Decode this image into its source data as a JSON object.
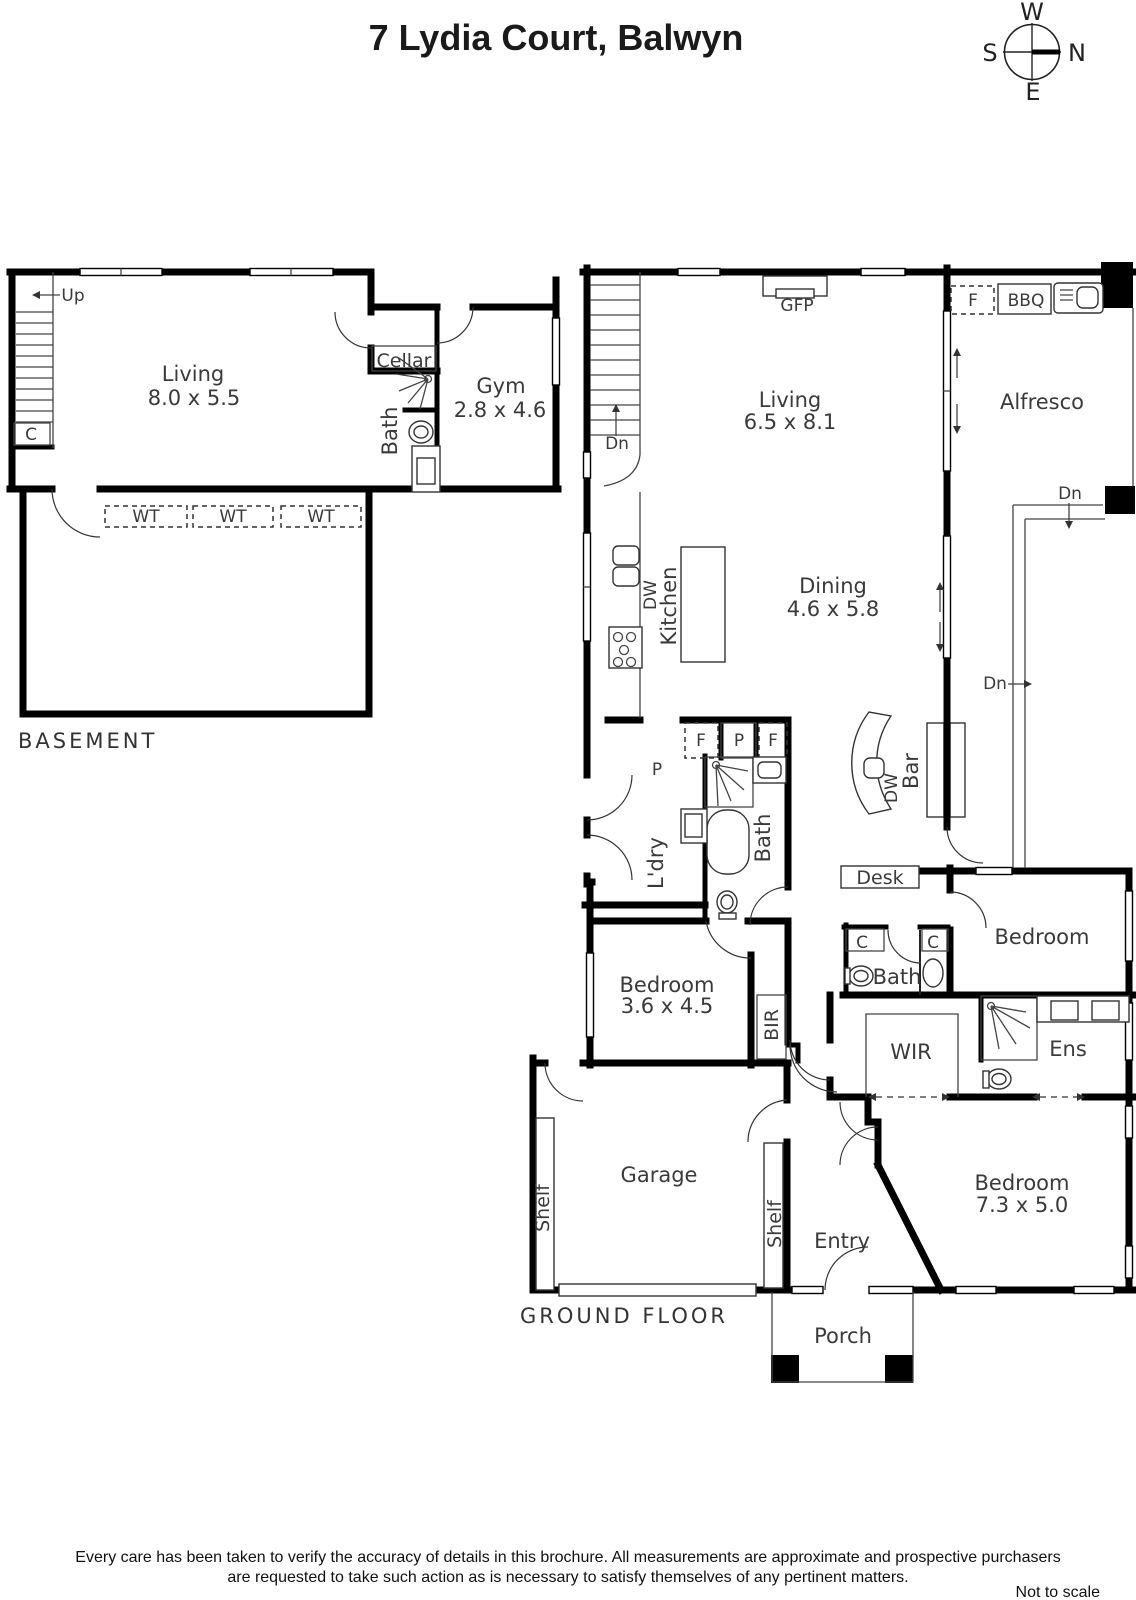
{
  "colors": {
    "wall": "#000000",
    "label": "#3a3a3a",
    "background": "#ffffff"
  },
  "title": "7 Lydia Court, Balwyn",
  "compass": {
    "top": "W",
    "right": "N",
    "left": "S",
    "bottom": "E"
  },
  "basement": {
    "floor": "BASEMENT",
    "up": "Up",
    "closet": "C",
    "living": "Living",
    "living_dims": "8.0 x 5.5",
    "cellar": "Cellar",
    "bath": "Bath",
    "gym": "Gym",
    "gym_dims": "2.8 x 4.6",
    "wt1": "WT",
    "wt2": "WT",
    "wt3": "WT"
  },
  "ground": {
    "floor": "GROUND FLOOR",
    "dn_stairs": "Dn",
    "gfp": "GFP",
    "living": "Living",
    "living_dims": "6.5 x 8.1",
    "fridge": "F",
    "bbq": "BBQ",
    "alfresco": "Alfresco",
    "dn_deck": "Dn",
    "dn_path": "Dn",
    "dw_kitchen": "DW",
    "kitchen": "Kitchen",
    "dining": "Dining",
    "dining_dims": "4.6 x 5.8",
    "pantry": "P",
    "f1": "F",
    "p1": "P",
    "f2": "F",
    "ldry": "L'dry",
    "bath": "Bath",
    "dw_bar": "DW",
    "bar": "Bar",
    "desk": "Desk",
    "bedroom2": "Bedroom",
    "c1": "C",
    "c2": "C",
    "bath2": "Bath",
    "bedroom3": "Bedroom",
    "bedroom3_dims": "3.6 x 4.5",
    "bir": "BIR",
    "wir": "WIR",
    "ens": "Ens",
    "shelf1": "Shelf",
    "garage": "Garage",
    "shelf2": "Shelf",
    "entry": "Entry",
    "bedroom1": "Bedroom",
    "bedroom1_dims": "7.3 x 5.0",
    "porch": "Porch"
  },
  "footer": {
    "disclaimer_line1": "Every care has been taken to verify the accuracy of details in this brochure.  All measurements are approximate and prospective purchasers",
    "disclaimer_line2": "are requested to take such action as is necessary to satisfy themselves of any pertinent matters.",
    "scale_note": "Not to scale"
  }
}
